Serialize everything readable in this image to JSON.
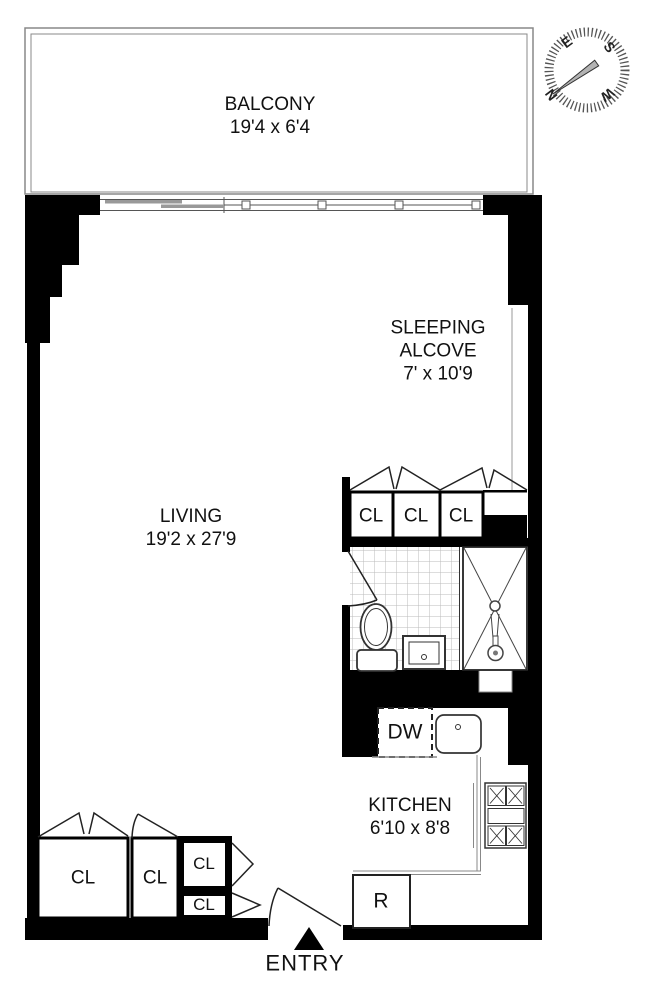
{
  "rooms": {
    "balcony": {
      "name": "BALCONY",
      "dims": "19'4 x 6'4"
    },
    "sleeping_alcove": {
      "name": "SLEEPING ALCOVE",
      "dims": "7' x 10'9"
    },
    "living": {
      "name": "LIVING",
      "dims": "19'2 x 27'9"
    },
    "kitchen": {
      "name": "KITCHEN",
      "dims": "6'10 x 8'8"
    },
    "entry": {
      "name": "ENTRY"
    }
  },
  "labels": {
    "closet": "CL",
    "dishwasher": "DW",
    "refrigerator": "R"
  },
  "compass": {
    "north": "N",
    "east": "E",
    "south": "S",
    "west": "W"
  },
  "colors": {
    "wall": "#000000",
    "thin_line": "#777777",
    "tile_line": "#bbbbbb",
    "needle": "#b3b3b3"
  }
}
